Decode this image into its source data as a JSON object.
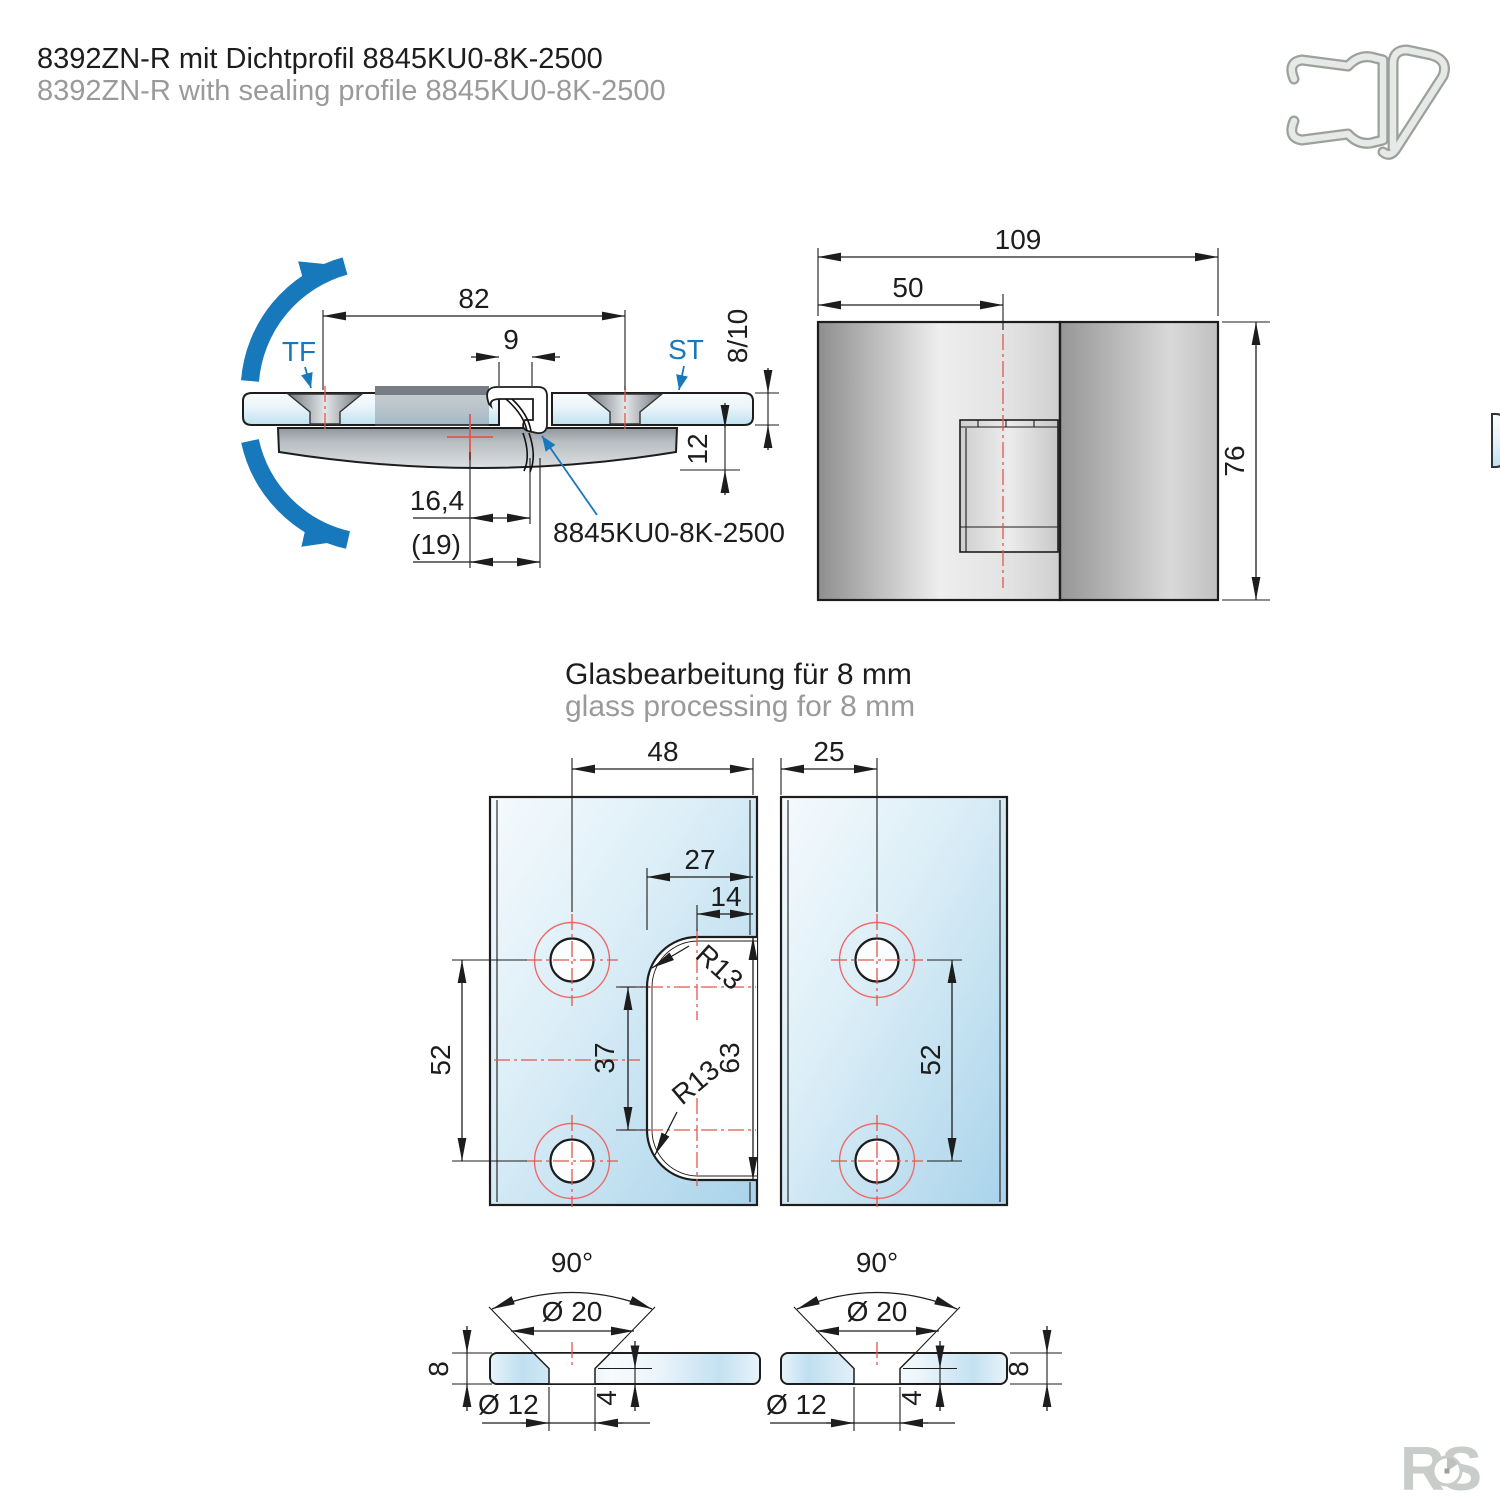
{
  "page": {
    "title_de": "8392ZN-R mit Dichtprofil 8845KU0-8K-2500",
    "title_en": "8392ZN-R with sealing profile 8845KU0-8K-2500"
  },
  "colors": {
    "accent_blue": "#1878bc",
    "centerline_red": "#e2574c",
    "glass_blue": "#bfe1f1",
    "metal_gray": "#b9bec2",
    "muted_text": "#9a9a9a"
  },
  "icons": {
    "seal_profile": "seal-profile-cross-section-icon"
  },
  "side_view": {
    "labels": {
      "door_leaf": "TF",
      "side_panel": "ST",
      "seal_callout": "8845KU0-8K-2500"
    },
    "dims": {
      "hole_spacing": "82",
      "seal_width": "9",
      "glass_thickness": "8/10",
      "body_depth": "12",
      "pivot_to_seal": "16,4",
      "pivot_to_seal_outer": "(19)"
    }
  },
  "front_view": {
    "dims": {
      "total_width": "109",
      "pivot_offset": "50",
      "height": "76"
    }
  },
  "glass_section": {
    "heading_de": "Glasbearbeitung für 8 mm",
    "heading_en": "glass processing for 8 mm",
    "left_panel": {
      "dims": {
        "hole_to_edge": "48",
        "notch_depth": "27",
        "radius_center_to_edge": "14",
        "hole_spacing": "52",
        "radius_centers_spacing": "37",
        "notch_height": "63",
        "radius_top": "R13",
        "radius_bottom": "R13"
      }
    },
    "right_panel": {
      "dims": {
        "edge_to_hole": "25",
        "hole_spacing": "52"
      }
    },
    "countersink_left": {
      "dims": {
        "angle": "90°",
        "countersink_diameter": "Ø 20",
        "glass_thickness": "8",
        "hole_diameter": "Ø 12",
        "cylinder_depth": "4"
      }
    },
    "countersink_right": {
      "dims": {
        "angle": "90°",
        "countersink_diameter": "Ø 20",
        "hole_diameter": "Ø 12",
        "cylinder_depth": "4",
        "glass_thickness": "8"
      }
    }
  },
  "footer": {
    "logo": "RS"
  }
}
